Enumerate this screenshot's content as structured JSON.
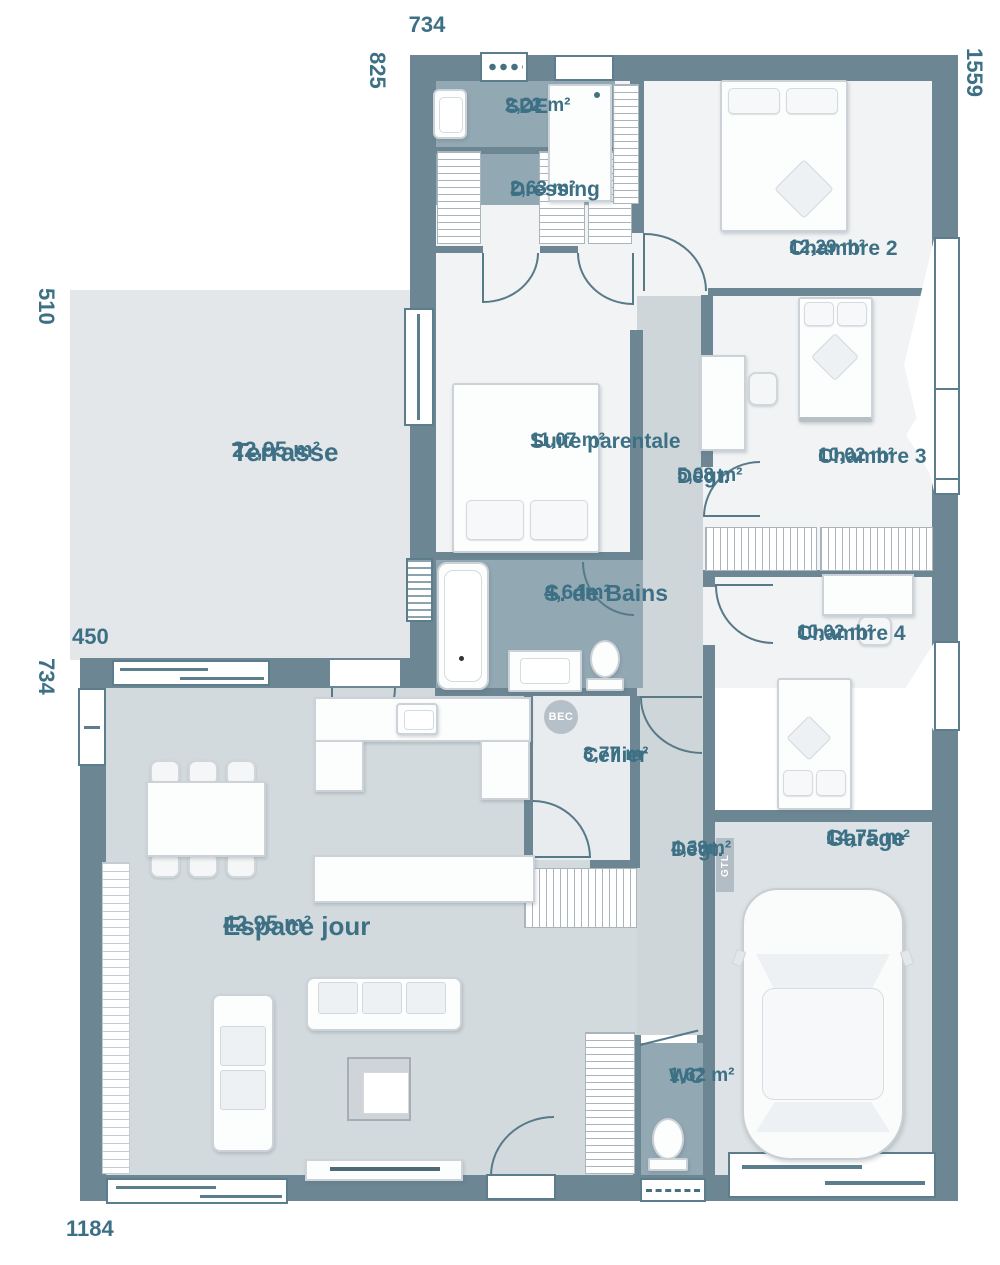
{
  "plan": {
    "dimensions": {
      "top_width": "734",
      "left_top_height": "825",
      "right_height": "1559",
      "terrace_height": "510",
      "terrace_width": "450",
      "left_bottom_height": "734",
      "bottom_width": "1184"
    },
    "rooms": [
      {
        "name": "SDE",
        "area": "2,22 m²"
      },
      {
        "name": "Dressing",
        "area": "2,63 m²"
      },
      {
        "name": "Chambre 2",
        "area": "12,29 m²"
      },
      {
        "name": "Terrasse",
        "area": "22,95 m²"
      },
      {
        "name": "Suite parentale",
        "area": "11,07 m²"
      },
      {
        "name": "Dégt.",
        "area": "5,08 m²"
      },
      {
        "name": "Chambre 3",
        "area": "10,02 m²"
      },
      {
        "name": "S. de Bains",
        "area": "4,64m²"
      },
      {
        "name": "Chambre 4",
        "area": "10,02 m²"
      },
      {
        "name": "Cellier",
        "area": "3,77 m²"
      },
      {
        "name": "Dégt.",
        "area": "4,39m²"
      },
      {
        "name": "Garage",
        "area": "14,75 m²"
      },
      {
        "name": "Espace jour",
        "area": "42,95 m²"
      },
      {
        "name": "WC",
        "area": "1,62 m²"
      }
    ],
    "tags": {
      "bec": "BEC",
      "gtl": "GTL"
    },
    "colors": {
      "wall": "#6c8694",
      "accent": "#3d7085",
      "wet_room": "#92a8b3",
      "terrace": "#e3e7ea",
      "living": "#d3dade",
      "corridor": "#ced6da",
      "bedroom": "#f1f3f4",
      "cellar": "#e9ecee",
      "garage": "#dce2e5"
    }
  }
}
